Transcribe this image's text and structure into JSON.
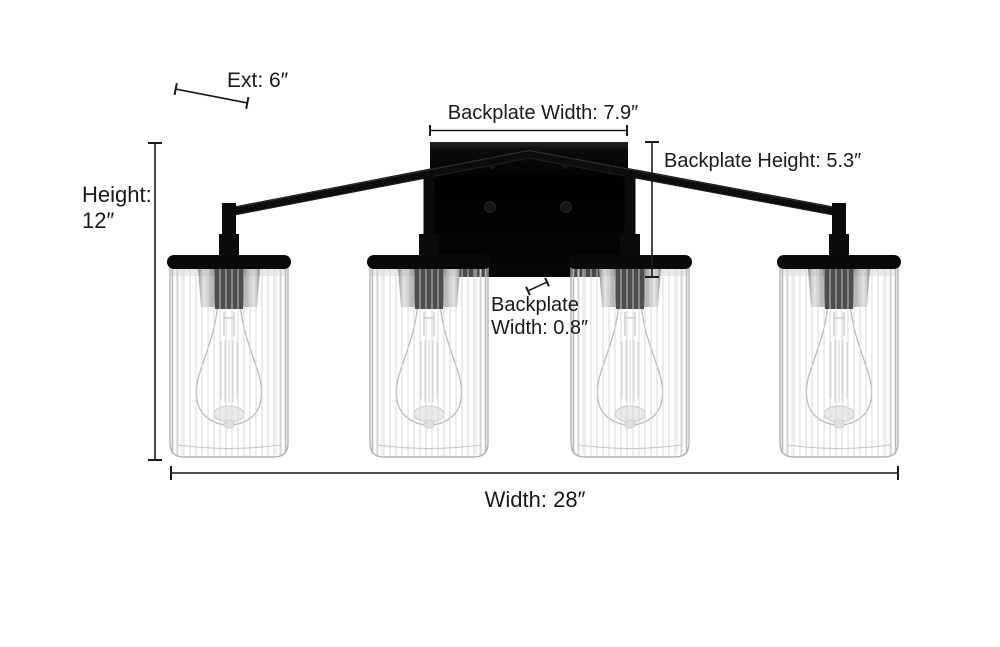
{
  "diagram": {
    "background_color": "#ffffff",
    "line_color": "#1a1a1a",
    "text_color": "#1a1a1a",
    "fixture": {
      "description": "4-light vanity wall fixture, matte black metal, clear fluted glass cylinder shades with Edison bulbs",
      "light_count": 4,
      "metal_color": "#0a0a0a"
    },
    "annotations": {
      "ext": {
        "label": "Ext: 6″",
        "value_in": 6
      },
      "backplate_width": {
        "label": "Backplate Width: 7.9″",
        "value_in": 7.9
      },
      "backplate_height": {
        "label": "Backplate Height: 5.3″",
        "value_in": 5.3
      },
      "height": {
        "line1": "Height:",
        "line2": "12″",
        "value_in": 12
      },
      "backplate_depth": {
        "line1": "Backplate",
        "line2": "Width: 0.8″",
        "value_in": 0.8
      },
      "width": {
        "label": "Width: 28″",
        "value_in": 28
      }
    }
  }
}
